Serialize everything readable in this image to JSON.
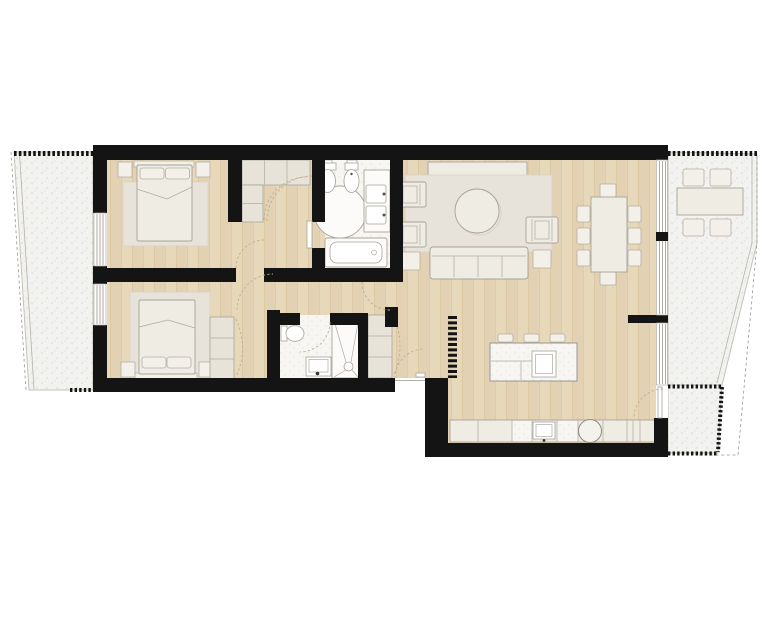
{
  "colors": {
    "background": "#ffffff",
    "wall": "#141414",
    "wood_floor": "#e8d8ba",
    "wood_grain": "#c9a876",
    "terrace": "#f2f2f0",
    "terrace_speckle": "#e1ded6",
    "tile": "#f7f6f3",
    "tile_speckle": "#e7e4dd",
    "furniture_fill": "#efece4",
    "furniture_outline": "#a9a399",
    "cabinet_fill": "#e7e3d9",
    "rug": "#e7e3da",
    "fixture_fill": "#fcfbf9",
    "door_arc": "#bdb097"
  },
  "plan": {
    "type": "residential-apartment-floor-plan",
    "rooms": [
      {
        "name": "bedroom-1",
        "furniture": [
          "double-bed",
          "two-pillows",
          "rug",
          "two-nightstands",
          "l-shaped-wardrobe"
        ]
      },
      {
        "name": "bedroom-2",
        "furniture": [
          "double-bed",
          "two-pillows",
          "rug",
          "two-nightstands",
          "wardrobe-column"
        ]
      },
      {
        "name": "main-bathroom",
        "fixtures": [
          "toilet",
          "bidet",
          "double-vanity",
          "round-shower",
          "bathtub"
        ]
      },
      {
        "name": "second-bathroom",
        "fixtures": [
          "toilet",
          "washbasin",
          "walk-in-shower"
        ]
      },
      {
        "name": "hallway",
        "features": [
          "coat-closet"
        ]
      },
      {
        "name": "living-dining-room",
        "furniture": [
          "sideboard",
          "rug",
          "round-coffee-table",
          "three-armchairs",
          "sofa",
          "two-side-tables",
          "dining-table",
          "eight-dining-chairs"
        ]
      },
      {
        "name": "kitchen",
        "features": [
          "island-with-sink",
          "three-bar-stools",
          "counter-run",
          "counter-sink",
          "round-basin",
          "slatted-screen"
        ]
      },
      {
        "name": "left-terrace",
        "furniture": []
      },
      {
        "name": "right-terrace",
        "furniture": [
          "outdoor-table",
          "four-outdoor-chairs"
        ]
      }
    ],
    "doors": [
      "entry-door",
      "bedroom-1-door",
      "bedroom-2-door",
      "ensuite-bathroom-door",
      "second-bathroom-door",
      "terrace-door"
    ],
    "windows": [
      "bedroom-1-window",
      "bedroom-2-window",
      "living-room-window",
      "kitchen-window"
    ]
  }
}
